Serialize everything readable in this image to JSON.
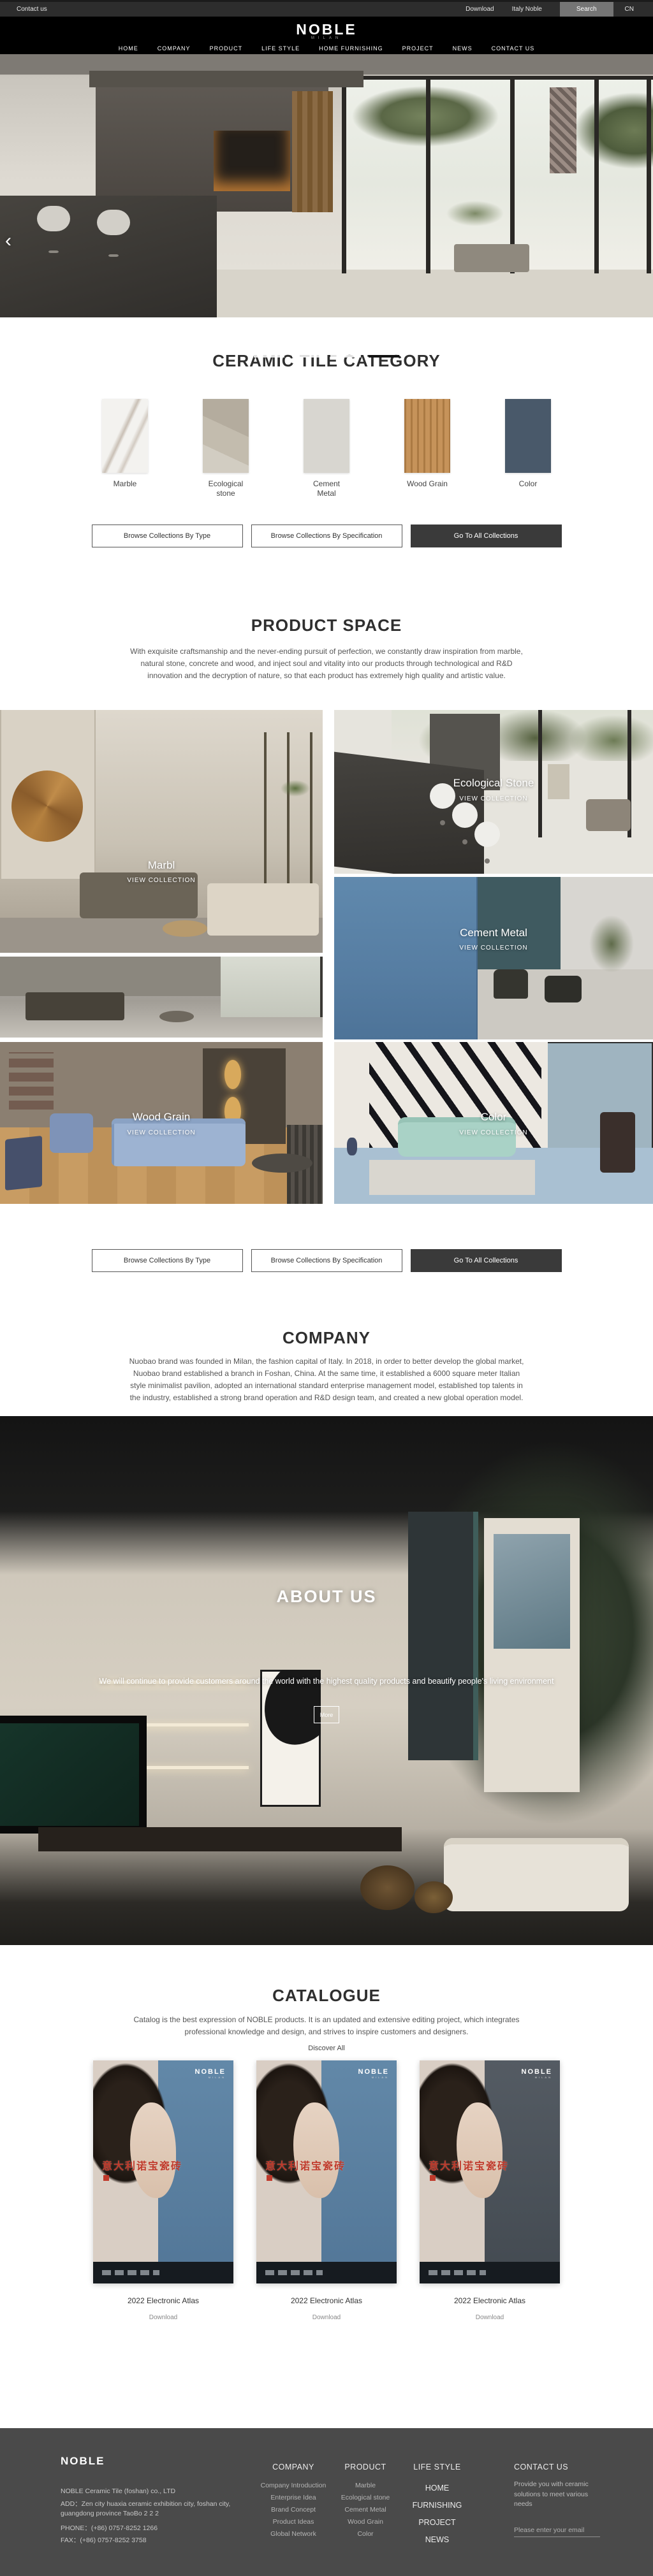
{
  "topbar": {
    "contact": "Contact us",
    "download": "Download",
    "italy": "Italy Noble",
    "search": "Search",
    "lang": "CN"
  },
  "header": {
    "logo": "NOBLE",
    "logo_sub": "MILAN",
    "nav": [
      "HOME",
      "COMPANY",
      "PRODUCT",
      "LIFE STYLE",
      "HOME FURNISHING",
      "PROJECT",
      "NEWS",
      "CONTACT US"
    ]
  },
  "hero": {
    "prev_arrow": "‹"
  },
  "category": {
    "title": "CERAMIC TILE CATEGORY",
    "items": [
      {
        "label": "Marble",
        "color": "#f3f2ef"
      },
      {
        "label": "Ecological stone",
        "color": "#c3bcae"
      },
      {
        "label": "Cement Metal",
        "color": "#d8d6d0"
      },
      {
        "label": "Wood Grain",
        "color": "#c6935a"
      },
      {
        "label": "Color",
        "color": "#49596a"
      }
    ]
  },
  "collection_buttons": {
    "by_type": "Browse Collections By Type",
    "by_spec": "Browse Collections By Specification",
    "go_all": "Go To All Collections"
  },
  "product_space": {
    "title": "PRODUCT SPACE",
    "description": "With exquisite craftsmanship and the never-ending pursuit of perfection, we constantly draw inspiration from marble, natural stone, concrete and wood, and inject soul and vitality into our products through technological and R&D innovation and the decryption of nature, so that each product has extremely high quality and artistic value.",
    "tiles": [
      {
        "label": "Marbl",
        "cta": "VIEW COLLECTION"
      },
      {
        "label": "",
        "cta": ""
      },
      {
        "label": "Wood Grain",
        "cta": "VIEW COLLECTION"
      },
      {
        "label": "Ecological Stone",
        "cta": "VIEW COLLECTION"
      },
      {
        "label": "Cement Metal",
        "cta": "VIEW COLLECTION"
      },
      {
        "label": "Color",
        "cta": "VIEW COLLECTION"
      }
    ]
  },
  "company": {
    "title": "COMPANY",
    "description": "Nuobao brand was founded in Milan, the fashion capital of Italy. In 2018, in order to better develop the global market, Nuobao brand established a branch in Foshan, China. At the same time, it established a 6000 square meter Italian style minimalist pavilion, adopted an international standard enterprise management model, established top talents in the industry, established a strong brand operation and R&D design team, and created a new global operation model."
  },
  "about": {
    "title": "ABOUT US",
    "description": "We will continue to provide customers around the world with the highest quality products and beautify people's living environment",
    "more": "More"
  },
  "catalogue": {
    "title": "CATALOGUE",
    "description": "Catalog is the best expression of NOBLE products. It is an updated and extensive editing project, which integrates professional knowledge and design, and strives to inspire customers and designers.",
    "discover": "Discover All",
    "items": [
      {
        "logo": "NOBLE",
        "logo_sub": "MILAN",
        "cover_title": "意大利诺宝瓷砖",
        "name": "2022 Electronic Atlas",
        "download": "Download"
      },
      {
        "logo": "NOBLE",
        "logo_sub": "MILAN",
        "cover_title": "意大利诺宝瓷砖",
        "name": "2022 Electronic Atlas",
        "download": "Download"
      },
      {
        "logo": "NOBLE",
        "logo_sub": "MILAN",
        "cover_title": "意大利诺宝瓷砖",
        "name": "2022 Electronic Atlas",
        "download": "Download"
      }
    ]
  },
  "footer": {
    "brand": "NOBLE",
    "company_line": "NOBLE Ceramic Tile (foshan) co., LTD",
    "address": "ADD：Zen city huaxia ceramic exhibition city, foshan city, guangdong province TaoBo 2 2 2",
    "phone": "PHONE：(+86) 0757-8252 1266",
    "fax": "FAX：(+86) 0757-8252 3758",
    "company_col": {
      "title": "COMPANY",
      "items": [
        "Company Introduction",
        "Enterprise Idea",
        "Brand Concept",
        "Product Ideas",
        "Global Network"
      ]
    },
    "product_col": {
      "title": "PRODUCT",
      "items": [
        "Marble",
        "Ecological stone",
        "Cement Metal",
        "Wood Grain",
        "Color"
      ]
    },
    "links_col": {
      "title": "LIFE STYLE",
      "items": [
        "HOME FURNISHING",
        "PROJECT",
        "NEWS"
      ]
    },
    "contact_col": {
      "title": "CONTACT US",
      "text": "Provide you with ceramic solutions to meet various needs",
      "placeholder": "Please enter your email"
    }
  }
}
